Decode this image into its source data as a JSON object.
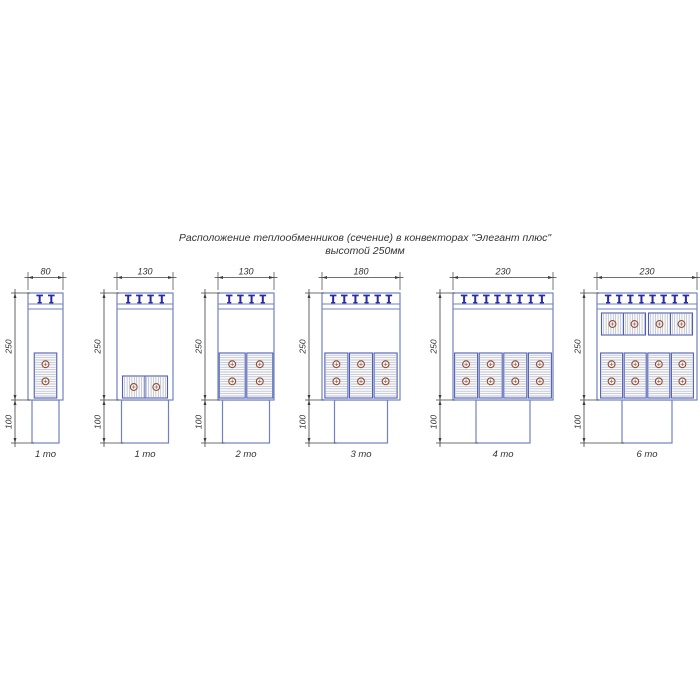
{
  "title": {
    "line1": "Расположение теплообменников (сечение) в конвекторах \"Элегант плюс\"",
    "line2": "высотой 250мм"
  },
  "colors": {
    "outline": "#7282c0",
    "bracket": "#2929a0",
    "block_border": "#4f5eb4",
    "hatch": "#a9b2d0",
    "tube_outline": "#8d4b40",
    "tube_fill": "#f7f4ec",
    "dimension": "#3f3f3f",
    "text": "#333333",
    "background": "#ffffff"
  },
  "convectors": [
    {
      "width_label": "80",
      "height_label": "250",
      "base_height_label": "100",
      "caption": "1 то",
      "bracket_count": 2,
      "upper_exchangers": 0,
      "lower_exchangers": 1,
      "lower_orientation": "vertical",
      "tubes_per_exchanger": 2
    },
    {
      "width_label": "130",
      "height_label": "250",
      "base_height_label": "100",
      "caption": "1 то",
      "bracket_count": 4,
      "upper_exchangers": 0,
      "lower_exchangers": 1,
      "lower_orientation": "horizontal",
      "tubes_per_exchanger": 2
    },
    {
      "width_label": "130",
      "height_label": "250",
      "base_height_label": "100",
      "caption": "2 то",
      "bracket_count": 4,
      "upper_exchangers": 0,
      "lower_exchangers": 2,
      "lower_orientation": "vertical",
      "tubes_per_exchanger": 2
    },
    {
      "width_label": "180",
      "height_label": "250",
      "base_height_label": "100",
      "caption": "3 то",
      "bracket_count": 6,
      "upper_exchangers": 0,
      "lower_exchangers": 3,
      "lower_orientation": "vertical",
      "tubes_per_exchanger": 2
    },
    {
      "width_label": "230",
      "height_label": "250",
      "base_height_label": "100",
      "caption": "4 то",
      "bracket_count": 8,
      "upper_exchangers": 0,
      "lower_exchangers": 4,
      "lower_orientation": "vertical",
      "tubes_per_exchanger": 2
    },
    {
      "width_label": "230",
      "height_label": "250",
      "base_height_label": "100",
      "caption": "6 то",
      "bracket_count": 8,
      "upper_exchangers": 2,
      "upper_orientation": "horizontal",
      "lower_exchangers": 4,
      "lower_orientation": "vertical",
      "tubes_per_exchanger": 2
    }
  ]
}
